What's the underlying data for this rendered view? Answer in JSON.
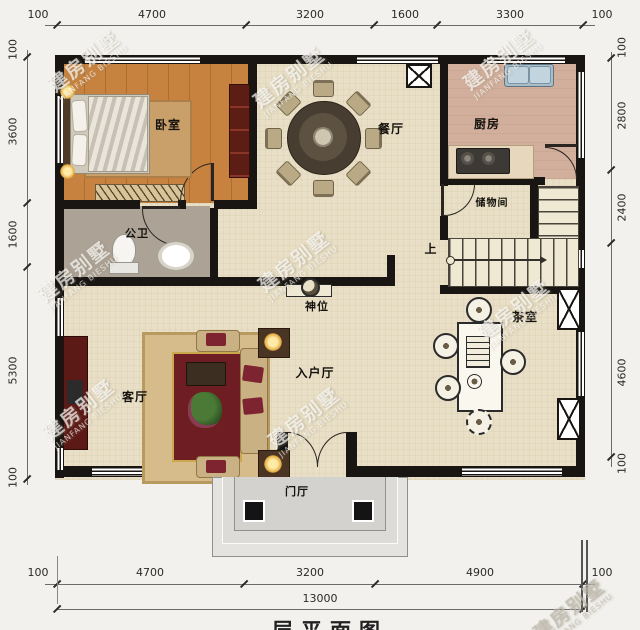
{
  "title": "层平面图",
  "watermark": {
    "cn": "建房别墅",
    "en": "JIANFANG BIESHU"
  },
  "dimensions": {
    "top": [
      "100",
      "4700",
      "3200",
      "1600",
      "3300",
      "100"
    ],
    "left": [
      "100",
      "3600",
      "1600",
      "5300",
      "100"
    ],
    "right": [
      "100",
      "2800",
      "2400",
      "4600",
      "100"
    ],
    "bottom": [
      "100",
      "4700",
      "3200",
      "4900",
      "100"
    ],
    "total_width": "13000"
  },
  "rooms": {
    "bedroom": "卧室",
    "dining": "餐厅",
    "kitchen": "厨房",
    "bathroom": "公卫",
    "storage": "储物间",
    "stairs_up": "上",
    "shrine": "神位",
    "living": "客厅",
    "entry_hall": "入户厅",
    "tea_room": "茶室",
    "porch": "门厅"
  },
  "colors": {
    "wall": "#181512",
    "bedroom_floor": "#c6823e",
    "cream_floor": "#e8dfc6",
    "kitchen_floor": "#d1af9c",
    "bath_floor": "#aca295",
    "accent_red": "#5c1a16"
  }
}
